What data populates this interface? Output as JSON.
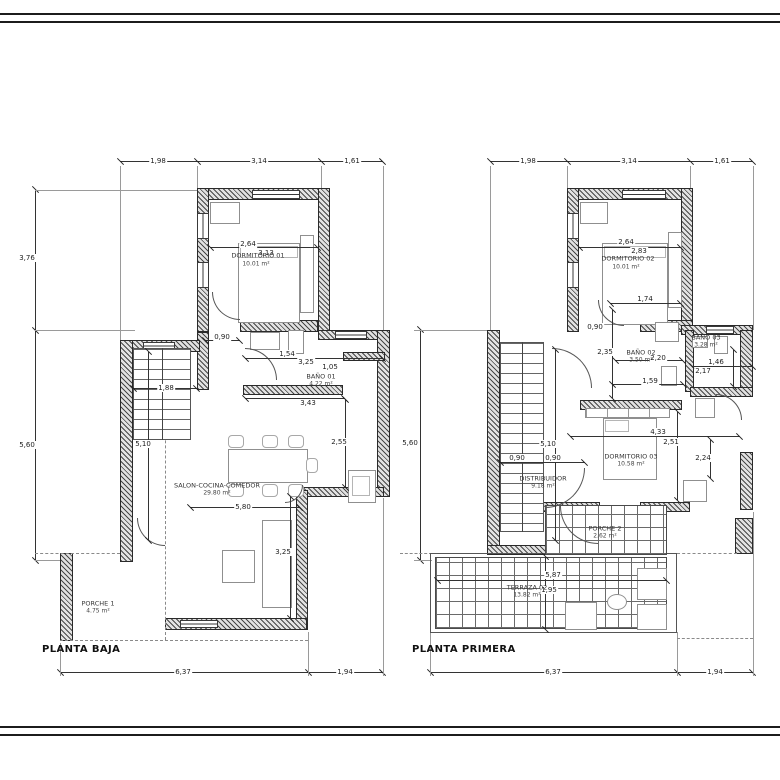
{
  "plans": {
    "baja": {
      "title": "PLANTA BAJA",
      "rooms": [
        {
          "name": "DORMITORIO 01",
          "area": "10.01 m²"
        },
        {
          "name": "BAÑO 01",
          "area": "4.22 m²"
        },
        {
          "name": "SALON-COCINA-COMEDOR",
          "area": "29.80 m²"
        },
        {
          "name": "PORCHE 1",
          "area": "4.75 m²"
        }
      ],
      "dims": {
        "top": [
          "1,98",
          "3,14",
          "1,61"
        ],
        "left": [
          "3,76",
          "5,60"
        ],
        "bottom": [
          "6,37",
          "1,94"
        ],
        "inner": [
          "2,64",
          "3,13",
          "0,90",
          "1,54",
          "3,25",
          "1,05",
          "1,88",
          "3,43",
          "5,10",
          "2,55",
          "5,80",
          "3,25"
        ]
      }
    },
    "primera": {
      "title": "PLANTA PRIMERA",
      "rooms": [
        {
          "name": "DORMITORIO 02",
          "area": "10.01 m²"
        },
        {
          "name": "BAÑO 02",
          "area": "3.50 m²"
        },
        {
          "name": "BAÑO 03",
          "area": "3.28 m²"
        },
        {
          "name": "DORMITORIO 03",
          "area": "10.58 m²"
        },
        {
          "name": "DISTRIBUIDOR",
          "area": "9.18 m²"
        },
        {
          "name": "PORCHE 2",
          "area": "2.62 m²"
        },
        {
          "name": "TERRAZA 02",
          "area": "13.82 m²"
        }
      ],
      "dims": {
        "top": [
          "1,98",
          "3,14",
          "1,61"
        ],
        "left": [
          "5,60"
        ],
        "bottom": [
          "6,37",
          "1,94"
        ],
        "inner": [
          "2,64",
          "2,83",
          "1,74",
          "0,90",
          "2,35",
          "2,20",
          "1,46",
          "2,17",
          "1,59",
          "4,33",
          "2,51",
          "2,24",
          "5,10",
          "0,90",
          "0,90",
          "5,87",
          "1,95"
        ]
      }
    }
  }
}
